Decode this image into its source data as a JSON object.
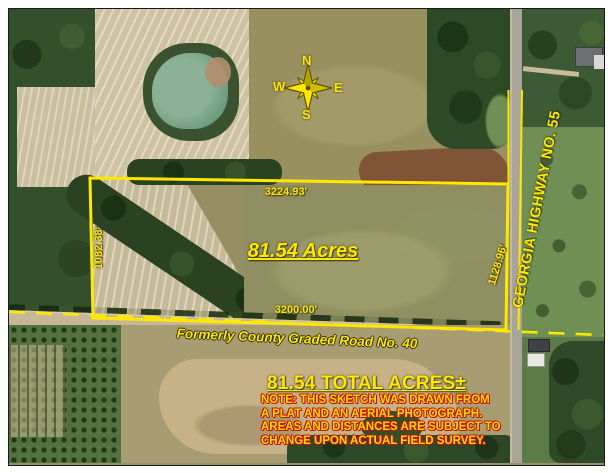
{
  "map": {
    "parcel": {
      "acres_label": "81.54 Acres",
      "dim_top": "3224.93'",
      "dim_left": "1082.38'",
      "dim_right": "1128.96'",
      "dim_bottom": "3200.00'"
    },
    "roads": {
      "highway_label": "GEORGIA HIGHWAY NO. 55",
      "county_road_label": "Formerly County Graded Road No. 40"
    },
    "compass": {
      "n": "N",
      "s": "S",
      "e": "E",
      "w": "W"
    },
    "summary": {
      "total_acres": "81.54 TOTAL ACRES±",
      "note_lines": [
        "NOTE: THIS SKETCH WAS DRAWN FROM",
        "A PLAT AND AN AERIAL PHOTOGRAPH.",
        "AREAS AND DISTANCES ARE SUBJECT TO",
        "CHANGE UPON ACTUAL FIELD SURVEY."
      ]
    },
    "colors": {
      "boundary_yellow": "#FFE800",
      "note_outline_red": "#C31400"
    }
  }
}
